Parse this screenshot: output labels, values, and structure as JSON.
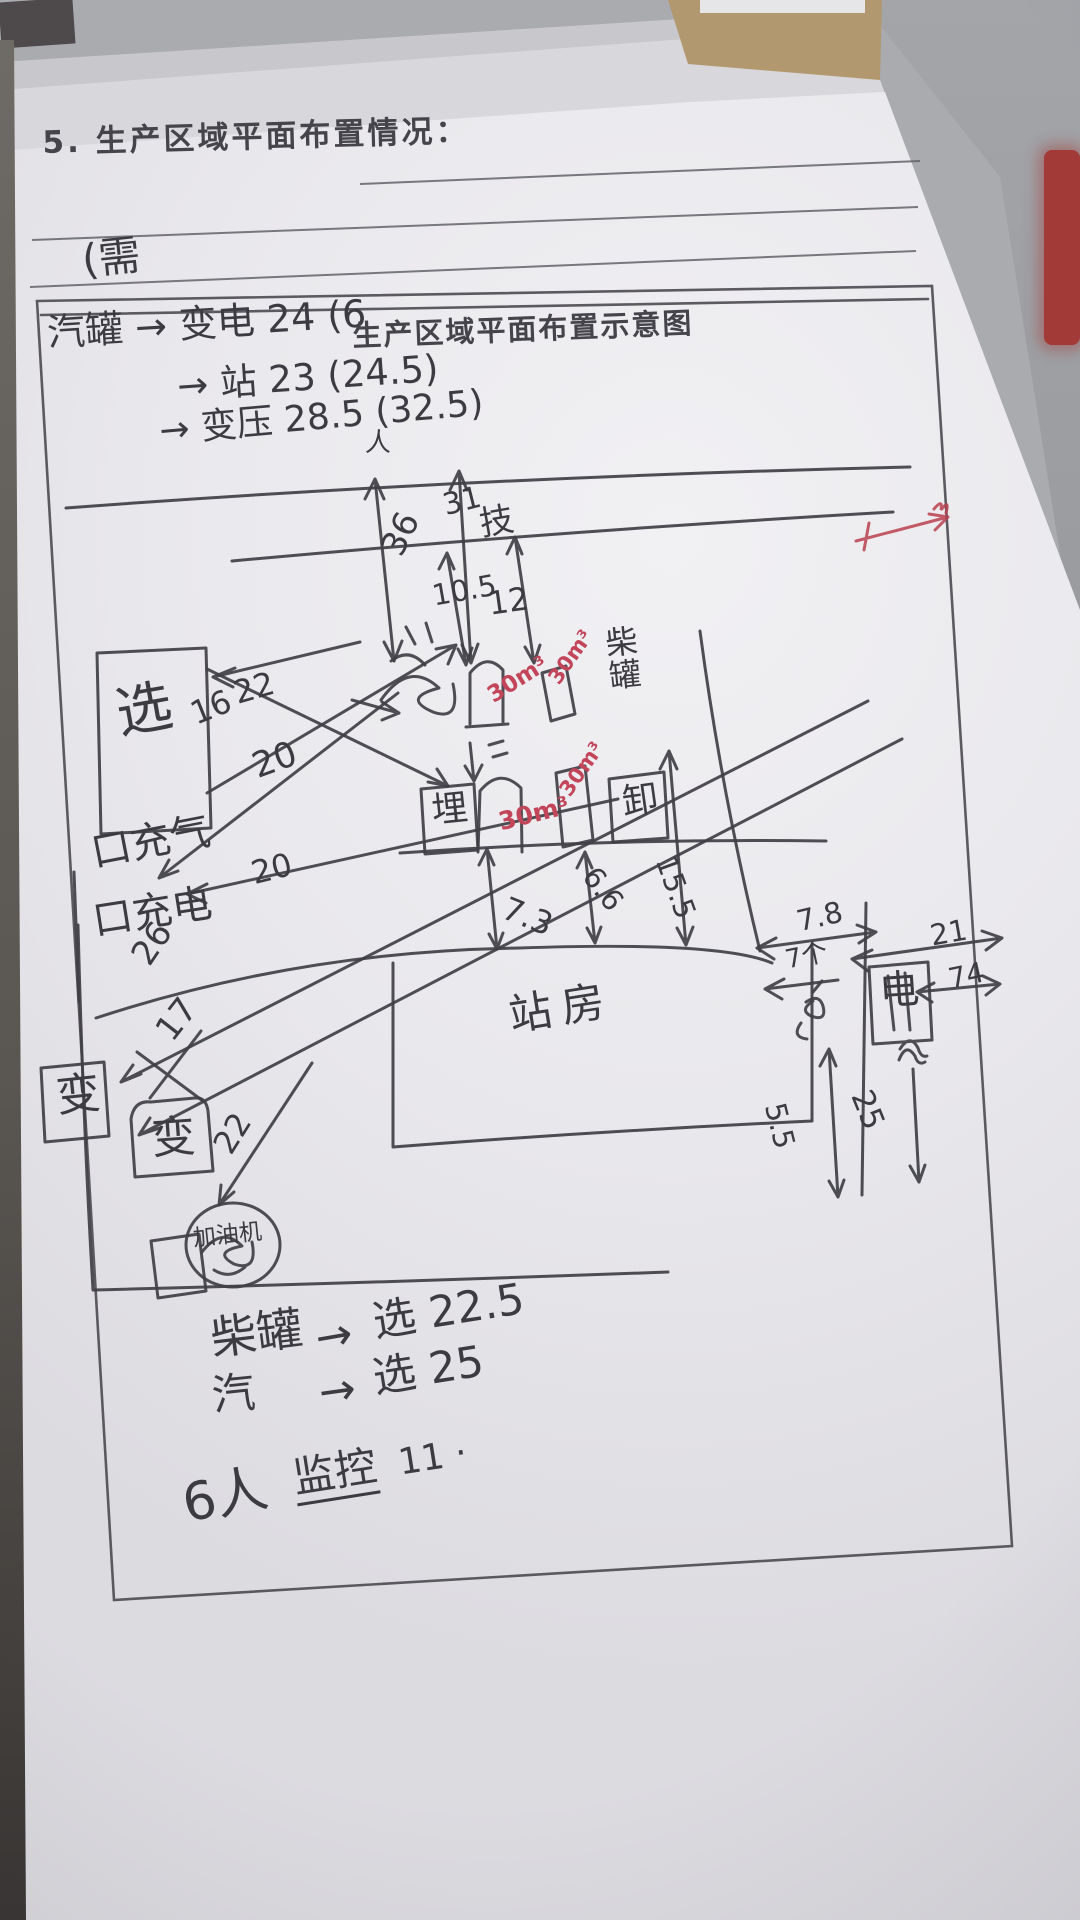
{
  "colors": {
    "ink": "#3f3f45",
    "red_ink": "#c2455a",
    "paper": "#e9e8ec",
    "desk": "#a3a5a9",
    "red_object": "#a23a38"
  },
  "header": {
    "number": "5.",
    "title": "生产区域平面布置情况：",
    "note_above_frame": "(需"
  },
  "frame_notes": {
    "line1_hand": "汽罐 → 变电 24 (6",
    "line1_print": "生产区域平面布置示意图",
    "line2": "→ 站 23  (24.5)",
    "line3": "→ 变压 28.5 (32.5)",
    "person": "人"
  },
  "sketch": {
    "d36": "36",
    "d31": "31",
    "wall": "技",
    "d105": "10.5",
    "d12": "12",
    "vol": "30m³",
    "tank_label": "柴罐",
    "d155": "15.5",
    "d66": "6.6",
    "d73": "7.3",
    "sel": "选",
    "d16": "16",
    "d22": "22",
    "d20": "20",
    "cb1": "口充气",
    "cb2": "口充电",
    "d26": "26",
    "d17": "17",
    "station": "站房",
    "buried": "埋",
    "unload": "卸",
    "d78": "7.8",
    "d21": "21",
    "cnt": "7个",
    "elec": "电",
    "d74": "74",
    "d55": "5.5",
    "d25": "25",
    "trans": "变",
    "d22b": "22",
    "dispenser": "加油机"
  },
  "footer_notes": {
    "l1a": "柴罐",
    "l1arrow": "→",
    "l1b": "选 22.5",
    "l2a": "汽",
    "l2arrow": "→",
    "l2b": "选 25",
    "staff": "6人",
    "monitor": "监控",
    "count": "11 ·"
  }
}
